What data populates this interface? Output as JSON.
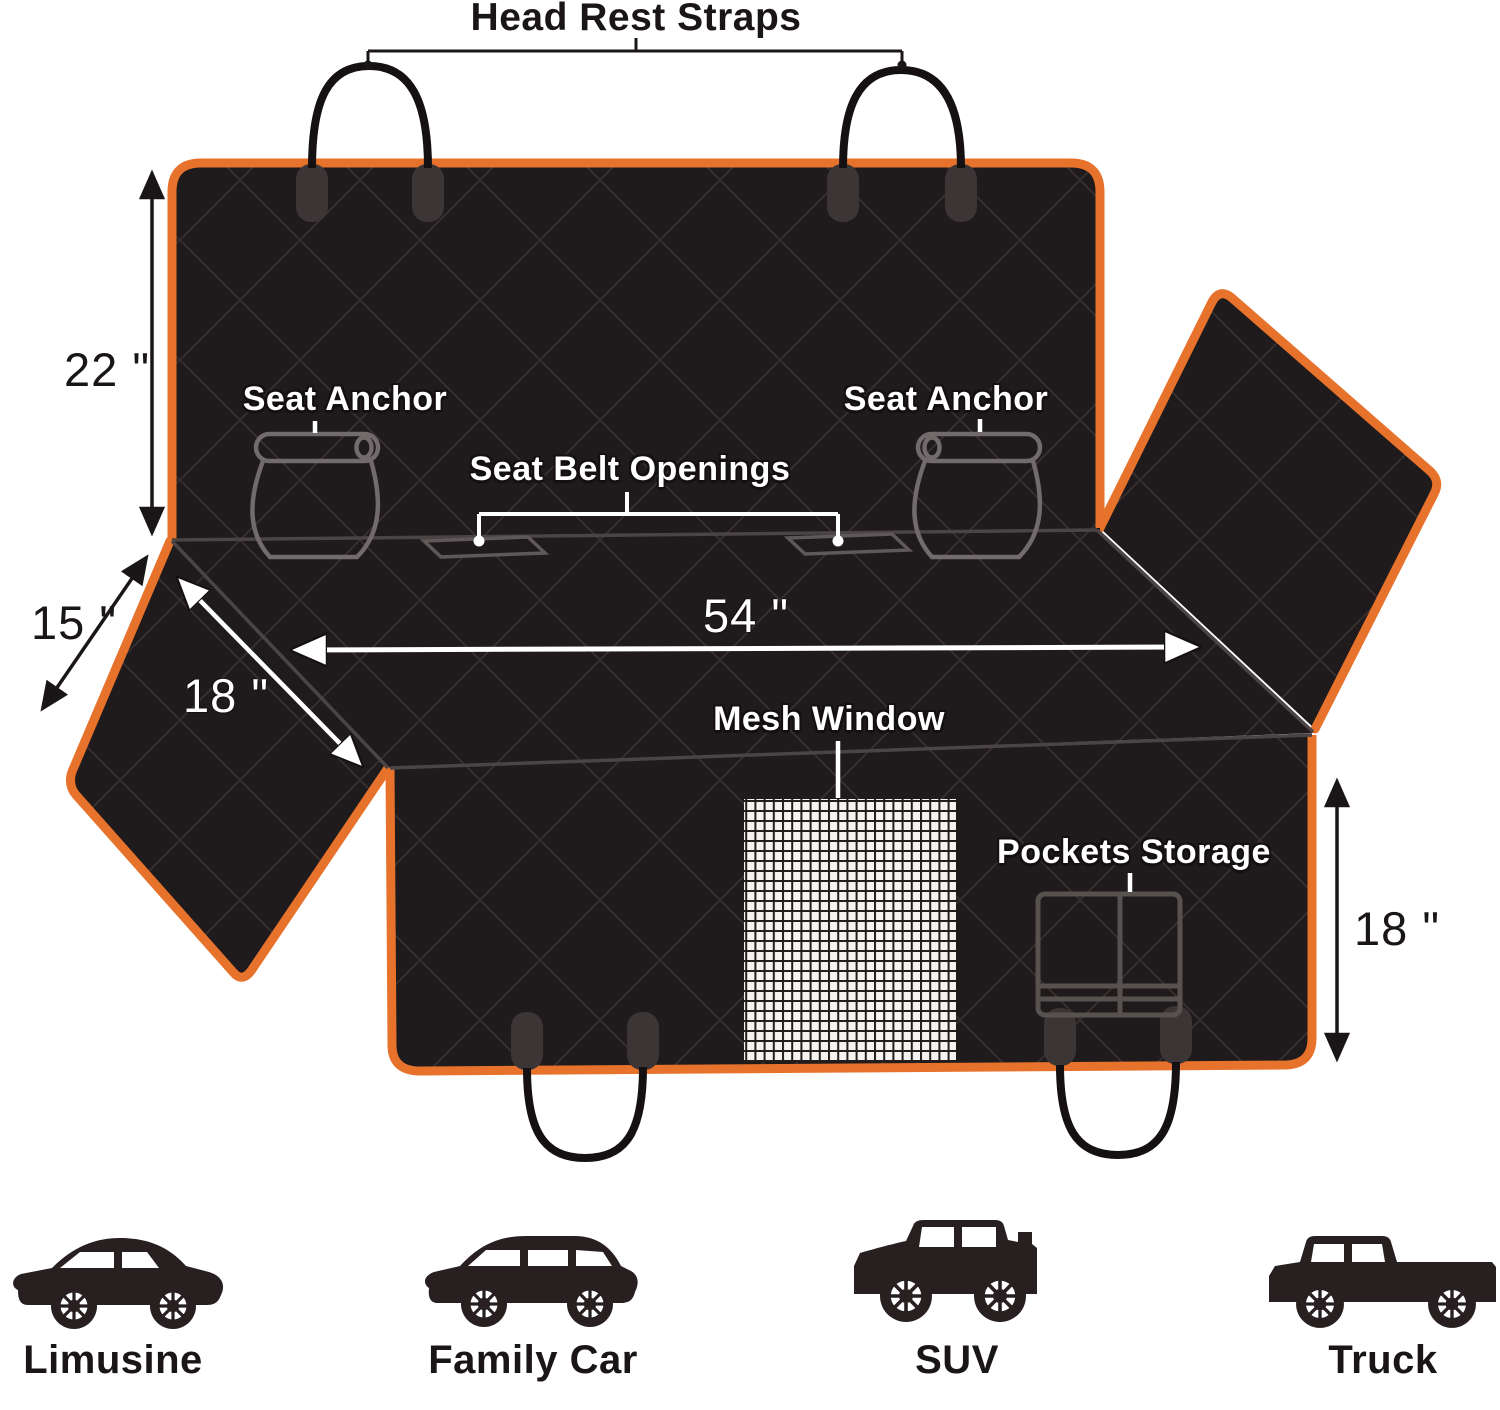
{
  "product": "dog car seat cover dimension diagram",
  "colors": {
    "accent_orange": "#E6722C",
    "fabric_black": "#1F1A1B",
    "quilt_line": "#363031",
    "fold_line": "#4A4445",
    "hardware_outline": "#716B6C",
    "mesh_background": "#F4F3EF",
    "label_white": "#FFFFFF",
    "label_black": "#1A1617",
    "vehicle_silhouette": "#271F20"
  },
  "labels": {
    "head_rest_straps": "Head Rest Straps",
    "seat_anchor_left": "Seat Anchor",
    "seat_anchor_right": "Seat Anchor",
    "seat_belt_openings": "Seat Belt Openings",
    "mesh_window": "Mesh Window",
    "pockets_storage": "Pockets Storage"
  },
  "dimensions": {
    "back_panel_height": "22 \"",
    "side_flap_edge": "15 \"",
    "side_flap_diagonal": "18 \"",
    "seat_width": "54 \"",
    "front_panel_drop": "18 \""
  },
  "vehicles": [
    {
      "label": "Limusine",
      "icon": "sedan-icon"
    },
    {
      "label": "Family Car",
      "icon": "wagon-icon"
    },
    {
      "label": "SUV",
      "icon": "suv-icon"
    },
    {
      "label": "Truck",
      "icon": "truck-icon"
    }
  ]
}
